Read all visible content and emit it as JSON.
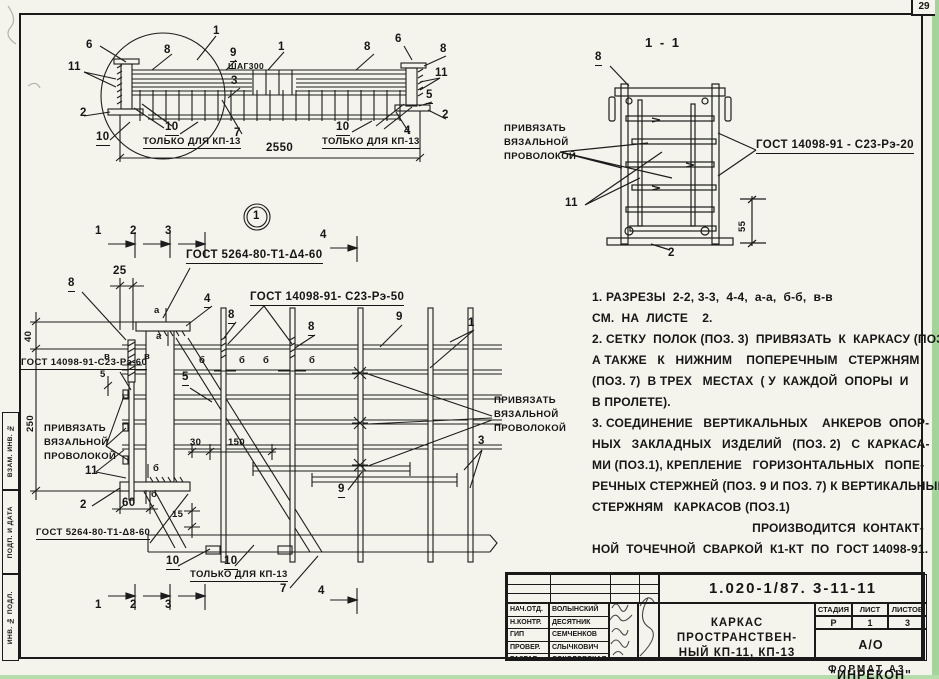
{
  "page": {
    "sheet_number": "29",
    "format_note": "ФОРМАТ А3"
  },
  "side_stamps": {
    "top": "ВЗАМ. ИНВ. №",
    "middle": "ПОДП. И ДАТА",
    "bottom": "ИНВ. № ПОДЛ."
  },
  "labels": {
    "n1": "1",
    "n2": "2",
    "n3": "3",
    "n4": "4",
    "n5": "5",
    "n6": "6",
    "n7": "7",
    "n8": "8",
    "n9": "9",
    "n10": "10",
    "n11": "11"
  },
  "marks": {
    "a": "а",
    "b": "б",
    "v": "в"
  },
  "dims": {
    "d2550": "2550",
    "shag": "ШАГ300",
    "d25": "25",
    "d40": "40",
    "d250": "250",
    "d5": "5",
    "d55": "55",
    "d60": "60",
    "d15": "15",
    "d30": "30",
    "d150": "150"
  },
  "texts": {
    "section_title": "1 - 1",
    "only_kp13": "ТОЛЬКО ДЛЯ КП-13",
    "tie1": "ПРИВЯЗАТЬ",
    "tie2": "ВЯЗАЛЬНОЙ",
    "tie3": "ПРОВОЛОКОЙ"
  },
  "gost": {
    "weld_t1_4": "ГОСТ 5264-80-Т1-Δ4-60",
    "weld_t1_8": "ГОСТ 5264-80-Т1-Δ8-60",
    "c23_50": "ГОСТ 14098-91- С23-Рэ-50",
    "c23_60": "ГОСТ 14098-91-С23-Рэ-60",
    "c23_20": "ГОСТ 14098-91 - С23-Рэ-20"
  },
  "notes": {
    "lines": [
      "1. РАЗРЕЗЫ  2-2, 3-3,  4-4,  а-а,  б-б,  в-в",
      "СМ.  НА  ЛИСТЕ    2.",
      "2. СЕТКУ  ПОЛОК (ПОЗ. 3)  ПРИВЯЗАТЬ  К  КАРКАСУ (ПОЗ.1),",
      "А ТАКЖЕ   К   НИЖНИМ    ПОПЕРЕЧНЫМ   СТЕРЖНЯМ",
      "(ПОЗ. 7)  В ТРЕХ   МЕСТАХ  ( У  КАЖДОЙ  ОПОРЫ  И",
      "В ПРОЛЕТЕ).",
      "3. СОЕДИНЕНИЕ   ВЕРТИКАЛЬНЫХ    АНКЕРОВ  ОПОР-",
      "НЫХ   ЗАКЛАДНЫХ   ИЗДЕЛИЙ   (ПОЗ. 2)   С  КАРКАСА-",
      "МИ (ПОЗ.1), КРЕПЛЕНИЕ   ГОРИЗОНТАЛЬНЫХ   ПОПЕ-",
      "РЕЧНЫХ СТЕРЖНЕЙ (ПОЗ. 9 И ПОЗ. 7) К ВЕРТИКАЛЬНЫМ",
      "СТЕРЖНЯМ   КАРКАСОВ (ПОЗ.1)",
      "ПРОИЗВОДИТСЯ  КОНТАКТ-",
      "НОЙ  ТОЧЕЧНОЙ  СВАРКОЙ  К1-КТ  ПО  ГОСТ 14098-91."
    ]
  },
  "title_block": {
    "doc_number": "1.020-1/87.   3-11-11",
    "rows": [
      {
        "role": "НАЧ.ОТД.",
        "name": "ВОЛЫНСКИЙ"
      },
      {
        "role": "Н.КОНТР.",
        "name": "ДЕСЯТНИК"
      },
      {
        "role": "ГИП",
        "name": "СЕМЧЕНКОВ"
      },
      {
        "role": "ПРОВЕР.",
        "name": "СЛЫЧКОВИЧ"
      },
      {
        "role": "РАЗРАБ.",
        "name": "СОКОЛОВСКАЯ"
      }
    ],
    "title_line1": "КАРКАС  ПРОСТРАНСТВЕН-",
    "title_line2": "НЫЙ  КП-11,  КП-13",
    "stage_label": "СТАДИЯ",
    "sheet_label": "ЛИСТ",
    "sheets_label": "ЛИСТОВ",
    "stage": "Р",
    "sheet": "1",
    "sheets": "3",
    "org": "А/О \"ИНРЕКОН\""
  }
}
